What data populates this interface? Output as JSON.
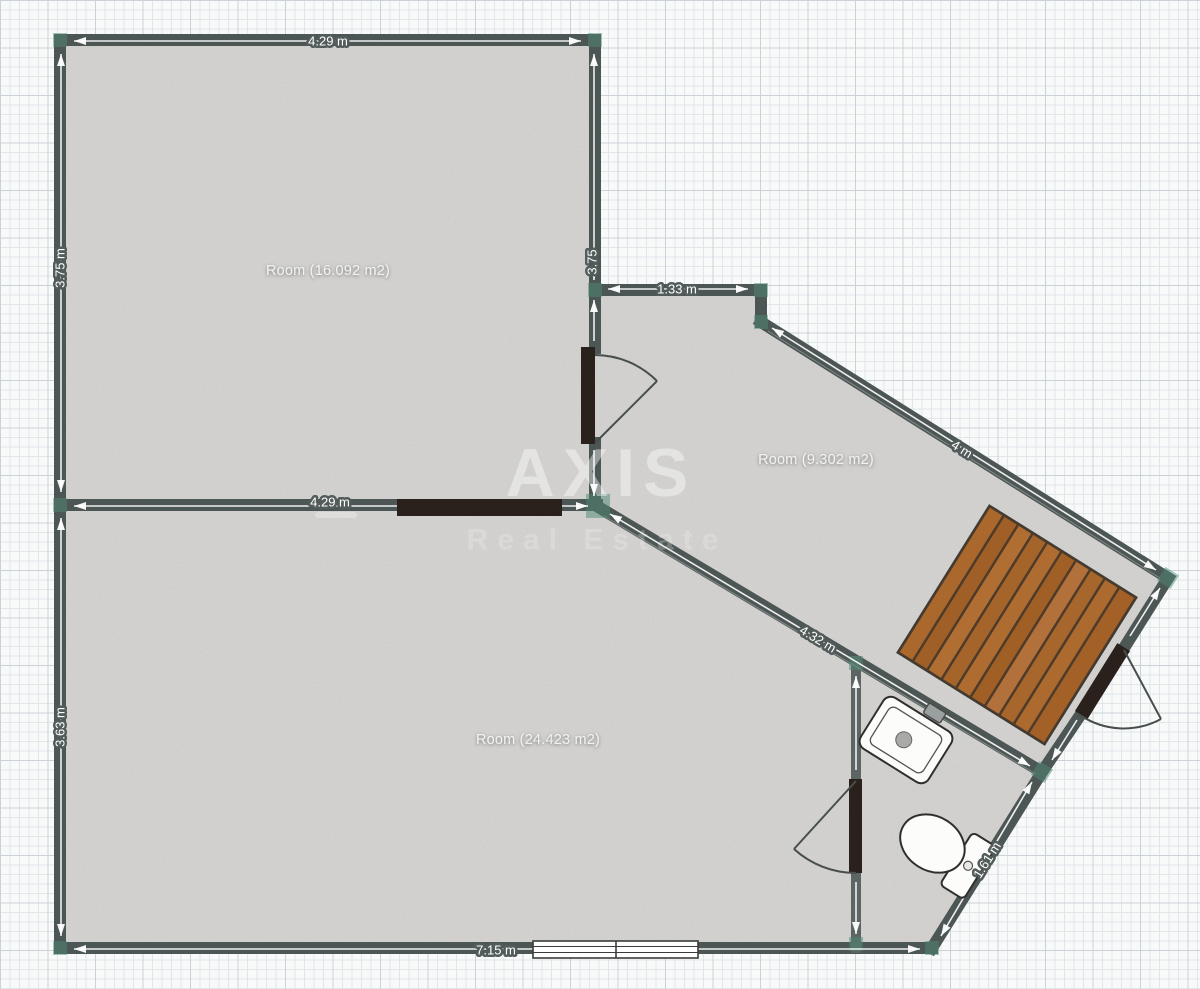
{
  "colors": {
    "wall": "#4c5654",
    "wall_interior": "#5b6563",
    "floor": "#d5d4d2",
    "grid_minor": "#e2e6e9",
    "grid_major": "#cbd2d7",
    "accent_teal": "#4d8873",
    "door_panel": "#2a211c",
    "deck_base": "#4e3b2a",
    "deck_plank": "#a9682c",
    "dim_text": "#ffffff",
    "label_text": "#f2f2f0",
    "fixture_outline": "#2f2f2d",
    "window_frame": "#3c3c3a",
    "arc_stroke": "#474e4c"
  },
  "watermark": {
    "title": "AXIS",
    "subtitle": "Real Estate"
  },
  "rooms": [
    {
      "name": "room-16",
      "label": "Room (16.092 m2)"
    },
    {
      "name": "room-9",
      "label": "Room (9.302 m2)"
    },
    {
      "name": "room-24",
      "label": "Room (24.423 m2)"
    }
  ],
  "dims": {
    "room16_top": "4.29 m",
    "room16_left": "3.75 m",
    "room16_right": "3.75",
    "room16_bottom": "4.29 m",
    "room9_top": "1.33 m",
    "room9_upper_diag": "4 m",
    "room9_lower_diag": "4.32 m",
    "bath_diag": "1.61 m",
    "room24_left": "3.63 m",
    "room24_bottom": "7.15 m"
  },
  "fixtures": {
    "deck": "wooden-deck",
    "sink": "bathroom-sink",
    "toilet": "toilet",
    "window": "window",
    "doors": [
      "door-room16-room9",
      "door-bathroom",
      "door-exterior"
    ]
  }
}
